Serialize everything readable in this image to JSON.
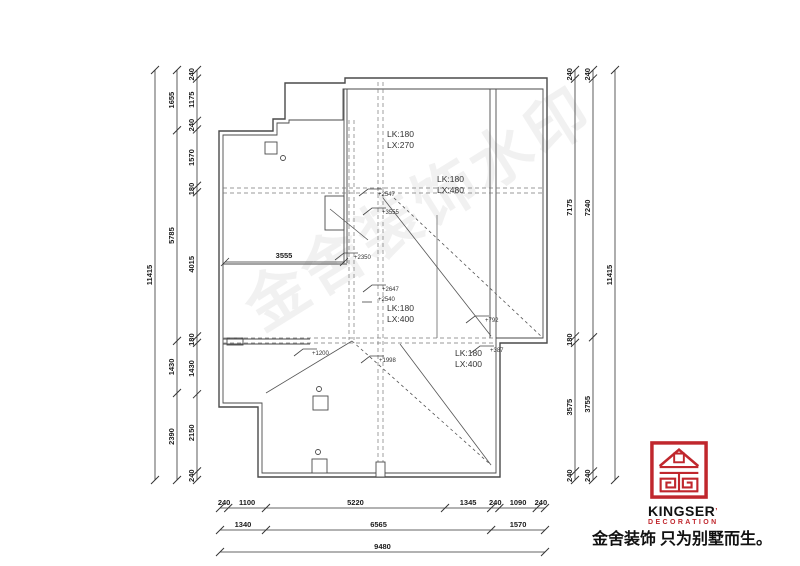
{
  "colors": {
    "line": "#4a4a4a",
    "accent_red": "#c0272d"
  },
  "watermark_text": "金舍装饰水印",
  "drawing": {
    "labels": {
      "lk1a": "LK:180",
      "lk1b": "LX:270",
      "lk2a": "LK:180",
      "lk2b": "LX:480",
      "lk3a": "LK:180",
      "lk3b": "LX:400",
      "lk4a": "LK:180",
      "lk4b": "LX:400",
      "dim3555": "3555",
      "e2547": "+2547",
      "e3555": "+3555",
      "e2350": "+2350",
      "e2647": "+2647",
      "e2540": "+2540",
      "e792": "+792",
      "e387": "+387",
      "e1200": "+1200",
      "e1998": "+1998"
    },
    "dims": {
      "left_outer": [
        "11415"
      ],
      "left_mid": [
        "1655",
        "5785",
        "1430",
        "2390"
      ],
      "left_inner": [
        "240",
        "1175",
        "240",
        "1570",
        "180",
        "4015",
        "180",
        "1430",
        "2150",
        "240"
      ],
      "right_inner": [
        "240",
        "7175",
        "180",
        "3575",
        "240"
      ],
      "right_mid": [
        "240",
        "7240",
        "3755",
        "240"
      ],
      "right_outer": [
        "11415"
      ],
      "bottom_r1": [
        "240",
        "1100",
        "5220",
        "1345",
        "240",
        "1090",
        "240"
      ],
      "bottom_r2": [
        "1340",
        "6565",
        "1570"
      ],
      "bottom_r3": [
        "9480"
      ]
    }
  },
  "logo": {
    "brand": "KINGSER",
    "sub": "DECORATION",
    "slogan": "金舍装饰 只为别墅而生。"
  }
}
